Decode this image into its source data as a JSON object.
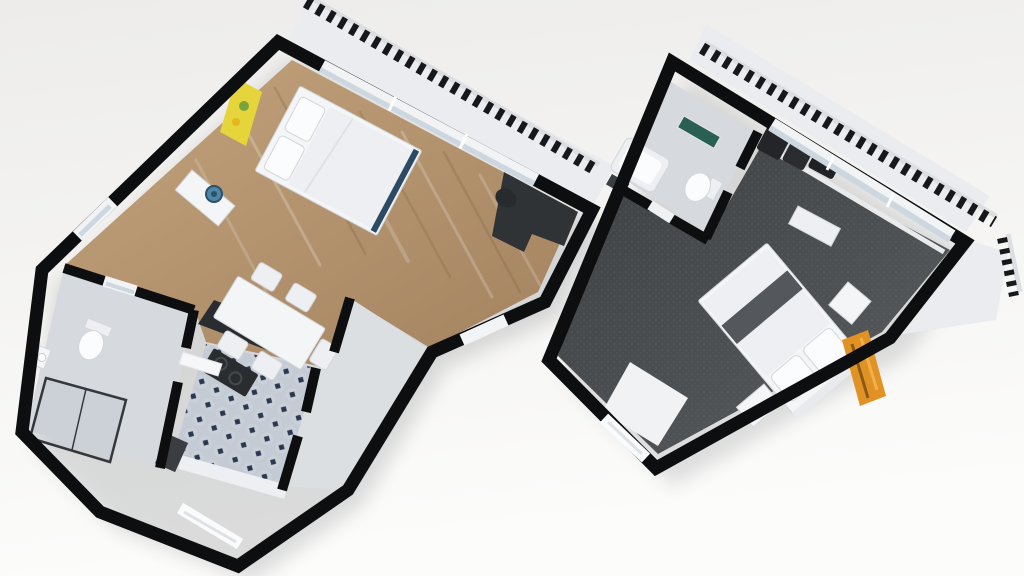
{
  "scene": {
    "type": "3d-floorplan-render",
    "description": "Top-down 3D dollhouse cutaway render of two apartment units, rotated diagonally on a plain light background",
    "units": [
      {
        "id": "left-unit",
        "rooms": [
          "bedroom-living",
          "kitchen",
          "bathroom",
          "entry-hall",
          "balcony"
        ],
        "furniture": [
          "double-bed",
          "pillows",
          "yellow-wall-art",
          "sideboard",
          "blue-vase",
          "dining-table",
          "dining-chairs",
          "black-counter-bar",
          "cooktop",
          "kitchen-cabinets",
          "appliance",
          "desk",
          "desk-chair",
          "shower-enclosure",
          "toilet",
          "washbasin",
          "balcony-railing",
          "windows",
          "entry-door"
        ]
      },
      {
        "id": "right-unit",
        "rooms": [
          "bedroom",
          "bathroom",
          "entry-nook",
          "balcony"
        ],
        "furniture": [
          "double-bed",
          "bed-runner",
          "pillows",
          "nightstand",
          "nightstand",
          "orange-wall-art",
          "bathtub-vanity",
          "mirror-shelf",
          "toilet",
          "washbasin-counter",
          "bath-mat",
          "dark-wardrobe",
          "bench",
          "balcony-railing",
          "windows",
          "entry-door"
        ]
      }
    ]
  },
  "colors": {
    "bg_top": "#edecea",
    "bg_bottom": "#fcfcfb",
    "wall": "#0d0e10",
    "wood_a": "#c2a37d",
    "wood_b": "#a3835f",
    "carpet_a": "#3d4043",
    "carpet_b": "#5a5d60",
    "carpet_speck": "#6b6e72",
    "tile_light": "#c4cbd5",
    "tile_mid": "#cdd3db",
    "tile_dark": "#2c3850",
    "bath_floor": "#d6d9dd",
    "hall_floor": "#dcdfe2",
    "balcony_floor": "#eaecef",
    "railing_dark": "#17181b",
    "railing_light": "#dcdee1",
    "white_furniture": "#f3f5f7",
    "furniture_stroke": "#d3d6da",
    "duvet": "#edeff2",
    "pillow": "#fbfcfd",
    "counter_dark": "#2a2d30",
    "desk_dark": "#303336",
    "glass": "#ccd7df",
    "window_frame": "#f2f3f4",
    "art_yellow": "#e5d53a",
    "art_green": "#79a43c",
    "art_orange": "#e09324",
    "art_orange_dark": "#8a5a14",
    "art_orange_light": "#f2b04a",
    "vase_blue": "#4d86ab",
    "vase_blue_dark": "#2c5066",
    "bed_runner": "#54585c",
    "bed_foot": "#2c4a63",
    "mirror_green": "#2a5f54",
    "appliance_dark": "#3a3e42",
    "shower_frame": "#34383c",
    "shadow": "#35373c"
  }
}
